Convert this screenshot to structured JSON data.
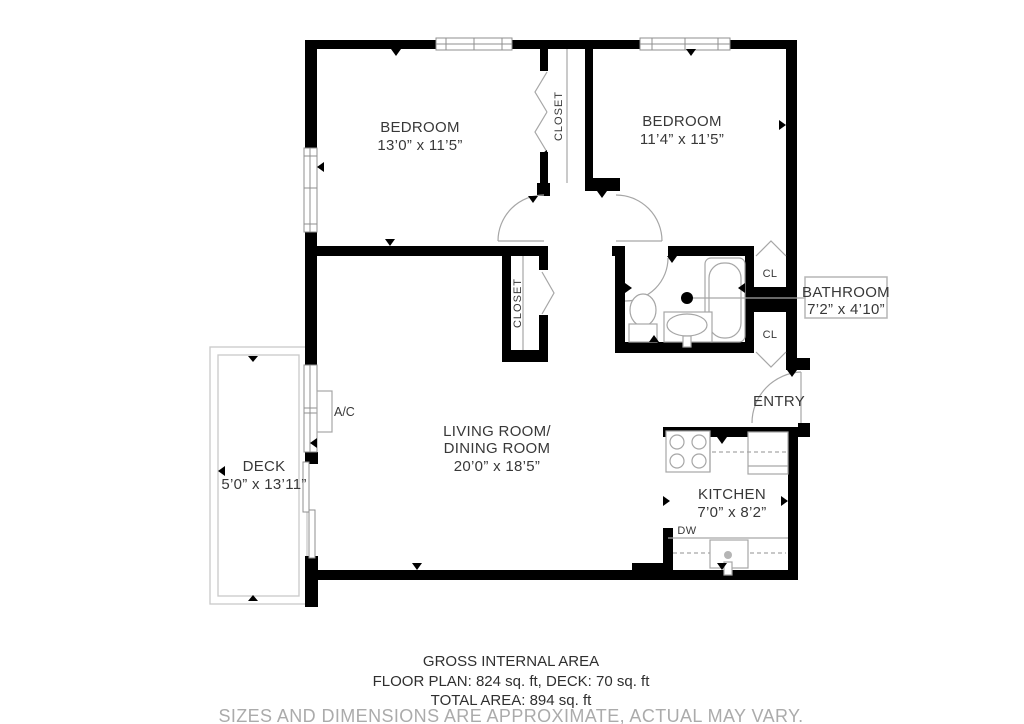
{
  "rooms": {
    "bedroom1": {
      "name": "BEDROOM",
      "dims": "13’0” x 11’5”"
    },
    "bedroom2": {
      "name": "BEDROOM",
      "dims": "11’4” x 11’5”"
    },
    "closet1": {
      "name": "CLOSET"
    },
    "closet2": {
      "name": "CLOSET"
    },
    "bathroom": {
      "name": "BATHROOM",
      "dims": "7’2” x 4’10”"
    },
    "cl_top": {
      "name": "CL"
    },
    "cl_bottom": {
      "name": "CL"
    },
    "entry": {
      "name": "ENTRY"
    },
    "living_dining": {
      "line1": "LIVING ROOM/",
      "line2": "DINING ROOM",
      "dims": "20’0” x 18’5”"
    },
    "kitchen": {
      "name": "KITCHEN",
      "dims": "7’0” x 8’2”"
    },
    "deck": {
      "name": "DECK",
      "dims": "5’0” x 13’11”"
    },
    "ac_unit": {
      "name": "A/C"
    },
    "dishwasher": {
      "name": "DW"
    }
  },
  "footer": {
    "heading": "GROSS INTERNAL AREA",
    "areas": "FLOOR PLAN: 824 sq. ft, DECK: 70 sq. ft",
    "total": "TOTAL AREA: 894 sq. ft",
    "disclaimer": "SIZES AND DIMENSIONS ARE APPROXIMATE, ACTUAL MAY VARY."
  },
  "colors": {
    "wall": "#000000",
    "fixture_line": "#a6a6a6",
    "deck_line": "#c9c9c9",
    "label_text": "#383838",
    "disclaimer_text": "#ababab",
    "label_box_border": "#b5b5b5"
  }
}
